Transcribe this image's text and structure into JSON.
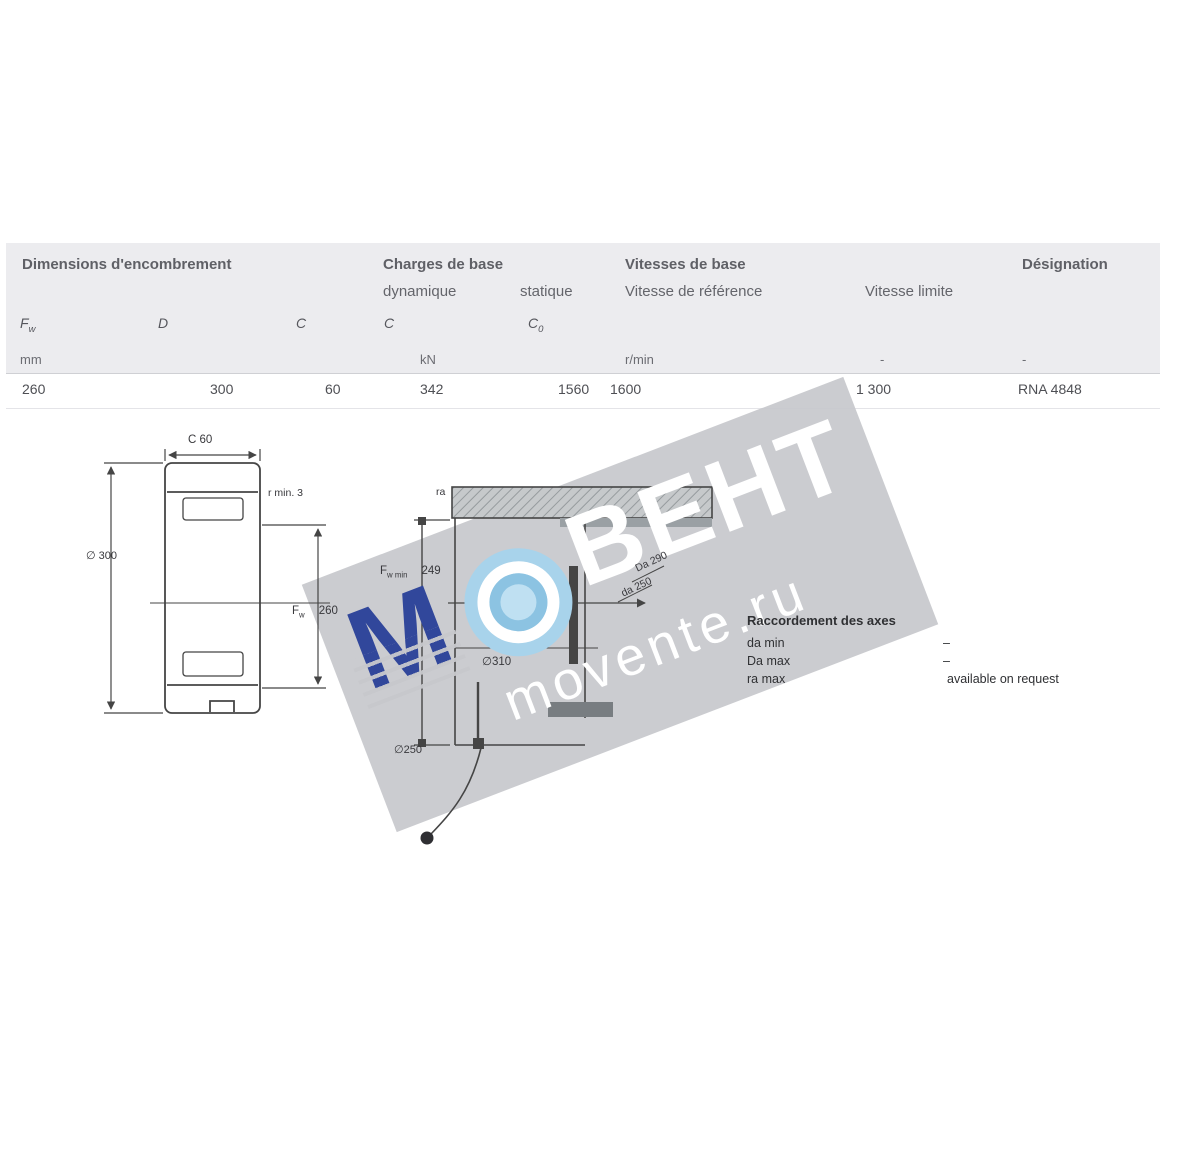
{
  "table": {
    "header": {
      "dimensions": "Dimensions d'encombrement",
      "loads": "Charges de base",
      "load_dynamic": "dynamique",
      "load_static": "statique",
      "speeds": "Vitesses de base",
      "speed_reference": "Vitesse de référence",
      "speed_limit": "Vitesse limite",
      "designation": "Désignation"
    },
    "symbols": {
      "fw_main": "F",
      "fw_sub": "w",
      "d": "D",
      "c": "C",
      "c_dyn": "C",
      "c0_main": "C",
      "c0_sub": "0"
    },
    "units": {
      "mm": "mm",
      "kn": "kN",
      "rpm": "r/min",
      "dash1": "-",
      "dash2": "-"
    },
    "row": {
      "fw": "260",
      "d": "300",
      "c": "60",
      "c_dyn": "342",
      "c0": "1560",
      "v_ref": "1600",
      "v_lim": "1 300",
      "designation": "RNA 4848"
    }
  },
  "left_drawing": {
    "dim_width": "C 60",
    "dim_outer": "∅ 300",
    "corner_note": "r min. 3",
    "bore_main": "F",
    "bore_sub": "w",
    "bore_value": "260"
  },
  "middle_drawing": {
    "ra_note": "ra",
    "fwmin_main": "F",
    "fwmin_sub": "w min",
    "fwmin_value": "249",
    "bore_dim": "∅310",
    "shaft_dim": "∅250",
    "da_note": "da 250",
    "Da_note": "Da 290"
  },
  "abutment": {
    "title": "Raccordement des axes",
    "rows": [
      {
        "label": "da min",
        "value": "–"
      },
      {
        "label": "Da max",
        "value": "–"
      },
      {
        "label": "ra max",
        "value": "available on request"
      }
    ]
  },
  "watermark": {
    "letter": "М",
    "brand": "ВЕНТ",
    "site": "movente.ru",
    "band_color": "#c7c8cc",
    "blue": "#31479b",
    "light_blue": "#a8d3eb"
  }
}
